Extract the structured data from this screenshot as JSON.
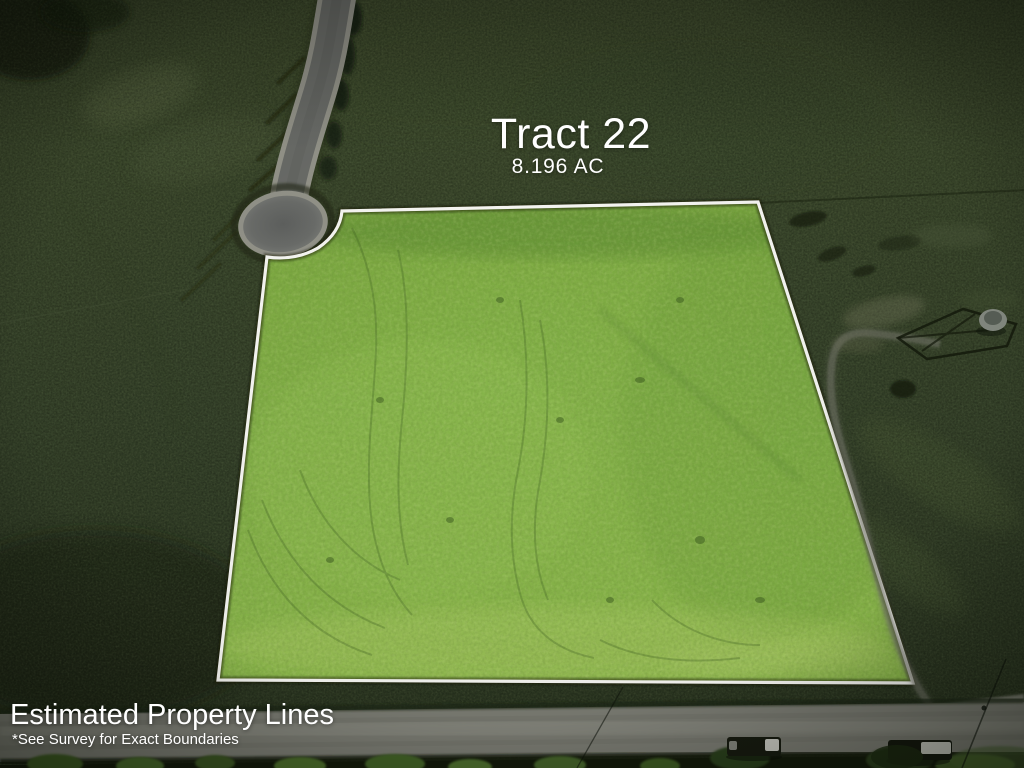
{
  "image": {
    "title": "Tract 22",
    "acreage": "8.196 AC",
    "disclaimer_heading": "Estimated Property Lines",
    "disclaimer_note": "*See Survey for Exact Boundaries"
  },
  "colors": {
    "boundary_line": "#f8f8f4",
    "highlight_grass": "#84b147",
    "field_grass": "#36432a",
    "road_asphalt": "#6e706b",
    "text": "#ffffff"
  }
}
